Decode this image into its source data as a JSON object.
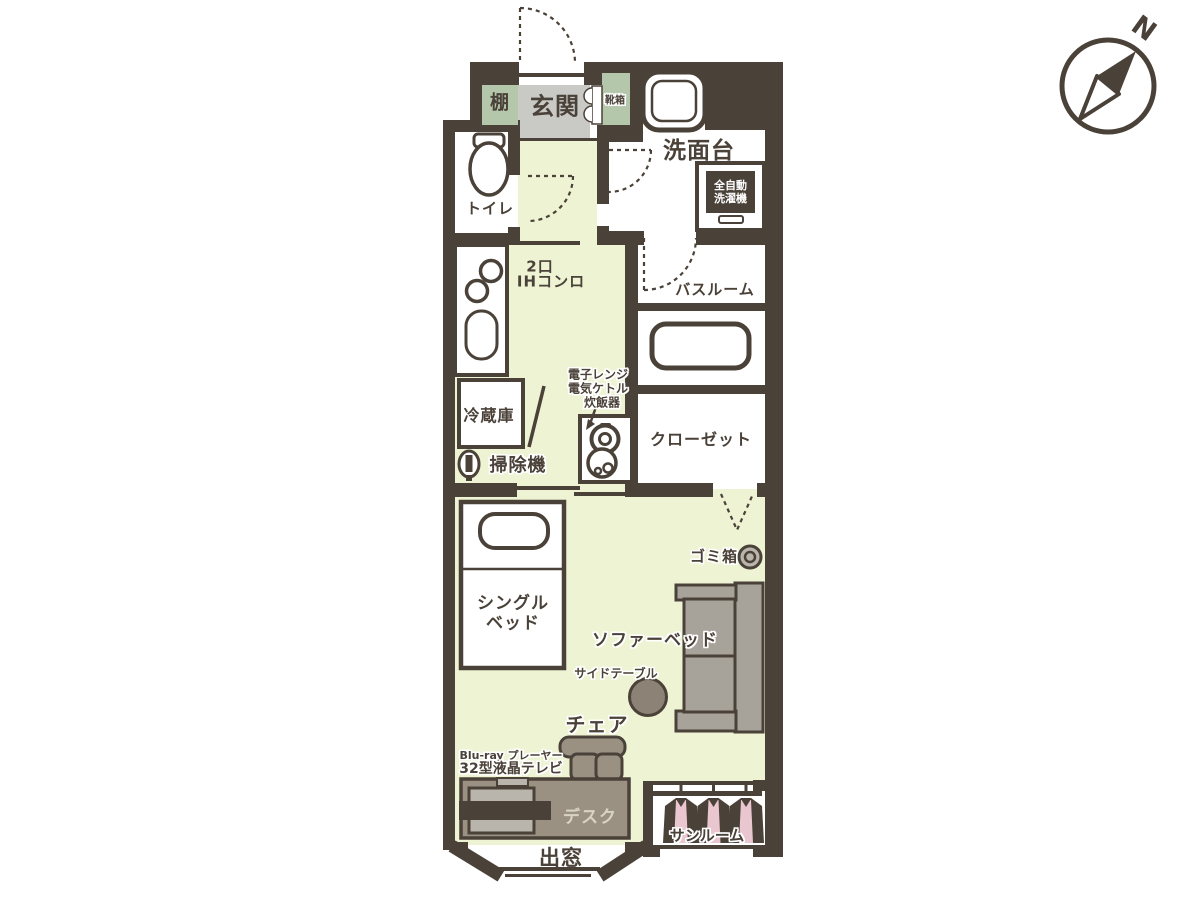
{
  "colors": {
    "wall": "#4a4138",
    "floor": "#edf3d3",
    "genkan": "#c9c9c6",
    "cab": "#b5c7ab",
    "sofa": "#a8a39a",
    "desk": "#9a9183",
    "tvgray": "#b9b5ad",
    "pink": "#eac6d0"
  },
  "compass": {
    "north_label": "N"
  },
  "labels": {
    "shelf": "棚",
    "entrance": "玄関",
    "shoe_box": "靴箱",
    "washstand": "洗面台",
    "washer_line1": "全自動",
    "washer_line2": "洗濯機",
    "toilet": "トイレ",
    "stove_line1": "2口",
    "stove_line2": "IHコンロ",
    "bathroom": "バスルーム",
    "fridge": "冷蔵庫",
    "appliance_line1": "電子レンジ",
    "appliance_line2": "電気ケトル",
    "appliance_line3": "炊飯器",
    "vacuum": "掃除機",
    "closet": "クローゼット",
    "trash_box": "ゴミ箱",
    "single_bed_line1": "シングル",
    "single_bed_line2": "ベッド",
    "sofa_bed": "ソファーベッド",
    "side_table": "サイドテーブル",
    "chair": "チェア",
    "bluray_player": "Blu-ray プレーヤー",
    "tv": "32型液晶テレビ",
    "desk": "デスク",
    "bay_window": "出窓",
    "sunroom": "サンルーム"
  }
}
